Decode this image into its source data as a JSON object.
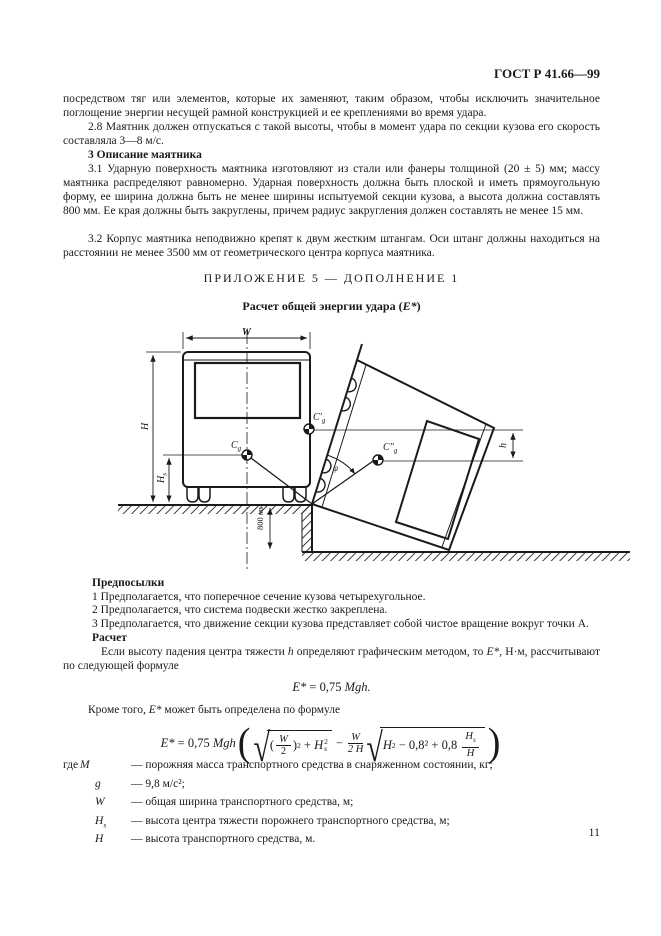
{
  "ink_color": "#1a1a1a",
  "paper_color": "#ffffff",
  "header": {
    "doc_code": "ГОСТ Р 41.66—99",
    "page_number": "11"
  },
  "body_text": {
    "p1": "посредством тяг или элементов, которые их заменяют, таким образом, чтобы исключить значительное поглощение энергии несущей рамной конструкцией и ее креплениями во время удара.",
    "p28": "2.8 Маятник должен отпускаться с такой высоты, чтобы в момент удара по секции кузова его скорость составляла 3—8 м/с.",
    "s3_title": "3 Описание маятника",
    "p31": "3.1 Ударную поверхность маятника изготовляют из стали или фанеры толщиной (20 ± 5) мм; массу маятника распределяют равномерно. Ударная поверхность должна быть плоской и иметь прямоугольную форму, ее ширина должна быть не менее ширины испытуемой секции кузова, а высота должна составлять 800 мм. Ее края должны быть закруглены, причем радиус закругления должен составлять не менее 15 мм.",
    "p32": "3.2 Корпус маятника неподвижно крепят к двум жестким штангам. Оси штанг должны находиться на расстоянии не менее 3500 мм от геометрического центра корпуса маятника."
  },
  "appendix": {
    "title": "ПРИЛОЖЕНИЕ 5 — ДОПОЛНЕНИЕ 1",
    "subtitle_pre": "Расчет общей энергии удара (",
    "subtitle_var": "Е*",
    "subtitle_post": ")"
  },
  "diagram": {
    "dim_w": "W",
    "dim_h": "H",
    "dim_hs_main": "H",
    "dim_hs_sub": "s",
    "dim_800": "800 мм",
    "dim_small_h": "h",
    "cg_main": "C",
    "cg_sub": "g",
    "cg_prime": "C′",
    "cg_dprime": "C″",
    "angle": "φ"
  },
  "assumptions": {
    "title": "Предпосылки",
    "items": [
      "1  Предполагается, что поперечное сечение кузова четырехугольное.",
      "2  Предполагается, что система подвески жестко закреплена.",
      "3  Предполагается, что движение секции кузова представляет собой чистое вращение вокруг точки А."
    ],
    "calc_title": "Расчет"
  },
  "calc_intro": {
    "a": "Если высоту падения центра тяжести ",
    "h": "h",
    "b": " определяют графическим методом, то ",
    "e": "Е*",
    "c": ", Н·м, рассчитывают по следующей формуле"
  },
  "formula1": {
    "e": "Е*",
    "mid": " = 0,75 ",
    "m": "Mgh."
  },
  "intro2": {
    "a": "Кроме того, ",
    "e": "Е*",
    "b": " может быть определена по формуле"
  },
  "formula_main": {
    "E": "Е*",
    "eq": "= 0,75",
    "coef": "Mgh",
    "open": "(",
    "close": ")",
    "rad": "√",
    "p_open": "(",
    "p_close": ")",
    "W": "W",
    "two": "2",
    "sq": "2",
    "plus": "+",
    "H": "H",
    "H_sup": "2",
    "H_sub": "s",
    "minus": "−",
    "fr_num": "W",
    "fr_den": "2 H",
    "H2": "H",
    "H2_sup": "2",
    "tail": "− 0,8² + 0,8",
    "Hs": "H",
    "Hs_sub": "s",
    "Hden": "H"
  },
  "definitions": {
    "where": "где",
    "items": [
      {
        "sym": "M",
        "sub": "",
        "text": "— порожняя масса транспортного средства в снаряженном состоянии, кг;"
      },
      {
        "sym": "g",
        "sub": "",
        "text": "— 9,8 м/с²;"
      },
      {
        "sym": "W",
        "sub": "",
        "text": "— общая ширина транспортного средства, м;"
      },
      {
        "sym": "H",
        "sub": "s",
        "text": "— высота центра тяжести порожнего транспортного средства, м;"
      },
      {
        "sym": "H",
        "sub": "",
        "text": "— высота транспортного средства, м."
      }
    ]
  }
}
